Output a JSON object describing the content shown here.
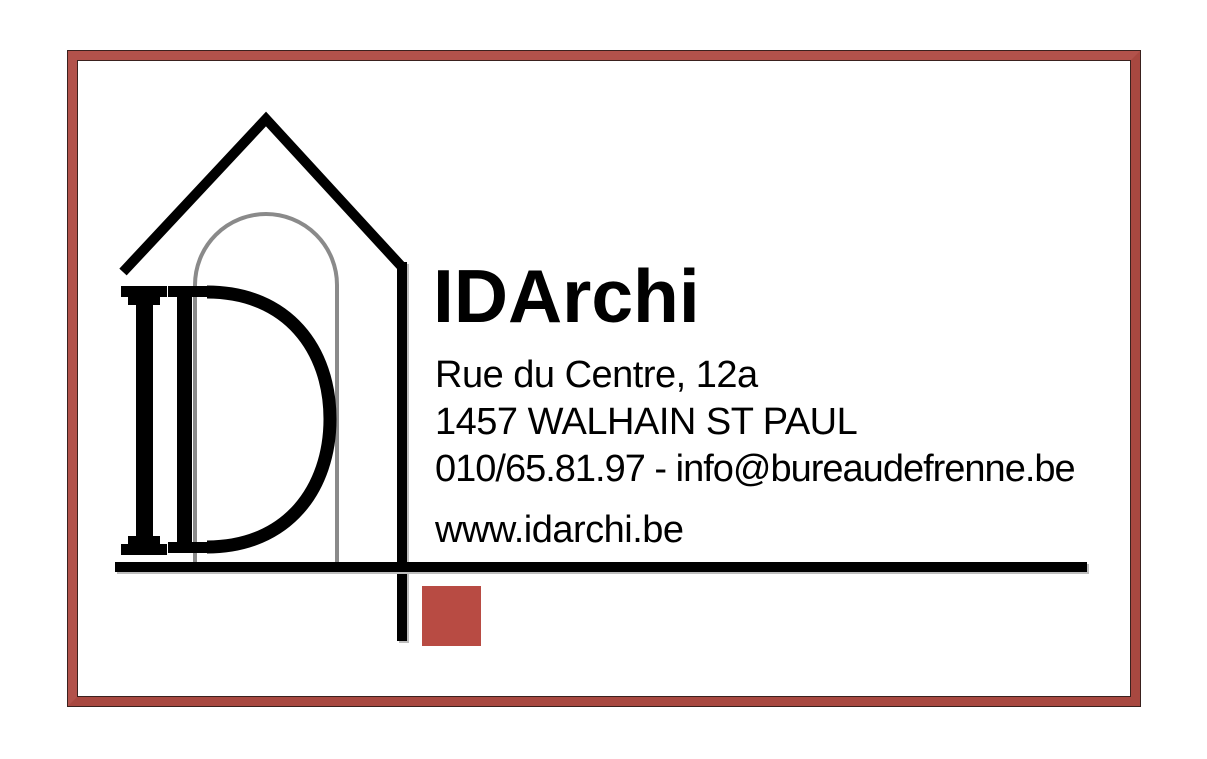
{
  "colors": {
    "frame": "#b2524b",
    "frame_shade": "#a84840",
    "frame_dark_edge": "#3a211e",
    "accent_square": "#b84b43",
    "ink": "#000000",
    "arch_gray": "#8a8a8a",
    "shadow_gray": "#bdbdbd"
  },
  "card": {
    "company_name": "IDArchi",
    "address_line1": "Rue du Centre, 12a",
    "address_line2": "1457 WALHAIN ST PAUL",
    "contact_line": "010/65.81.97 - info@bureaudefrenne.be",
    "website": "www.idarchi.be"
  },
  "logo": {
    "icon": "house-arch-id-monogram-icon",
    "elements": [
      "house-roof",
      "house-wall",
      "window-arch",
      "column-letter-i",
      "letter-d",
      "ground-line",
      "accent-square"
    ]
  }
}
